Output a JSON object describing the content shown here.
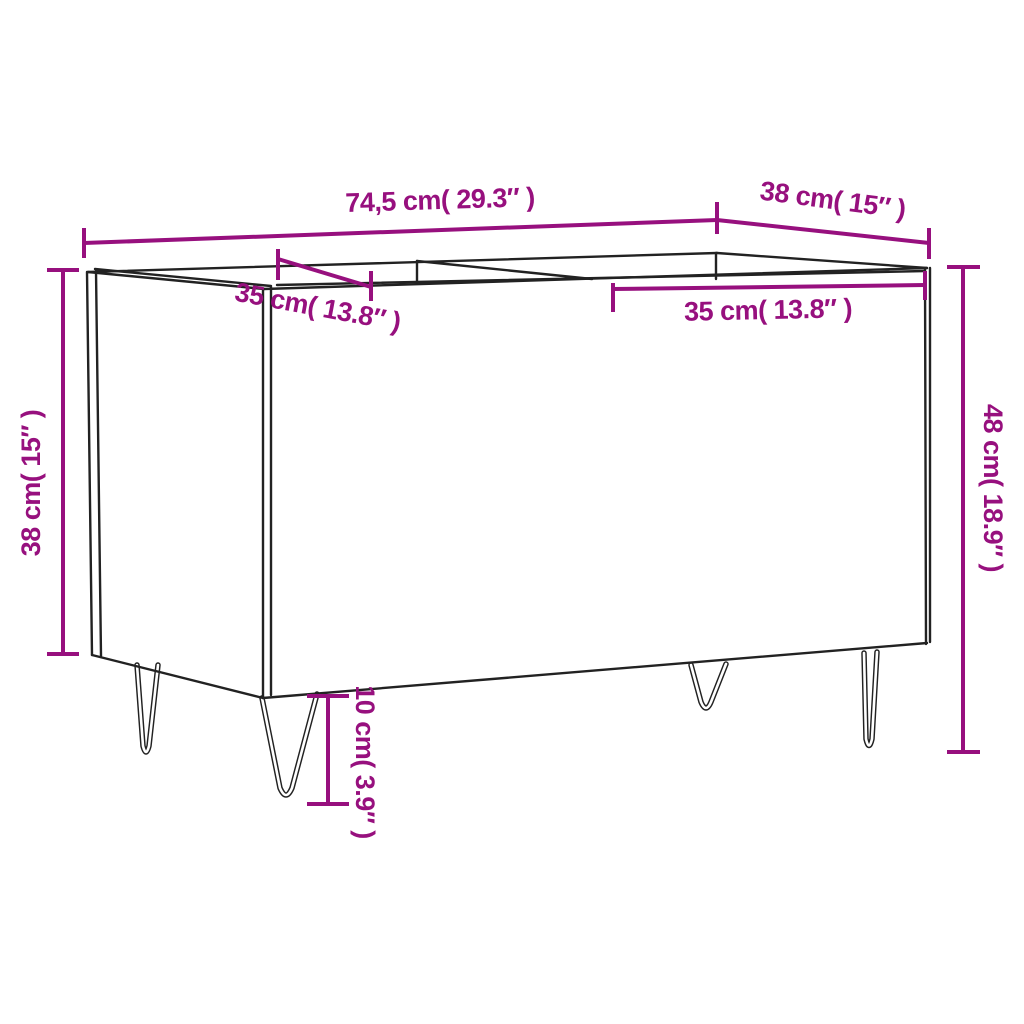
{
  "diagram": {
    "type": "furniture-dimension-diagram",
    "subject": "record cabinet with two open compartments and hairpin legs, three-quarter line-drawing view",
    "background_color": "#ffffff",
    "outline_color": "#222222",
    "dimension_color": "#97107E",
    "labels": {
      "overall_width": "74,5 cm( 29.3″ )",
      "top_depth": "38 cm( 15″ )",
      "left_compartment": "35 cm( 13.8″ )",
      "right_compartment": "35 cm( 13.8″ )",
      "body_height": "38 cm( 15″ )",
      "total_height": "48 cm( 18.9″ )",
      "leg_height": "10 cm( 3.9″ )"
    },
    "values": {
      "overall_width": {
        "cm": "74,5",
        "inches": "29.3"
      },
      "top_depth": {
        "cm": "38",
        "inches": "15"
      },
      "left_compartment": {
        "cm": "35",
        "inches": "13.8"
      },
      "right_compartment": {
        "cm": "35",
        "inches": "13.8"
      },
      "body_height": {
        "cm": "38",
        "inches": "15"
      },
      "total_height": {
        "cm": "48",
        "inches": "18.9"
      },
      "leg_height": {
        "cm": "10",
        "inches": "3.9"
      }
    }
  }
}
